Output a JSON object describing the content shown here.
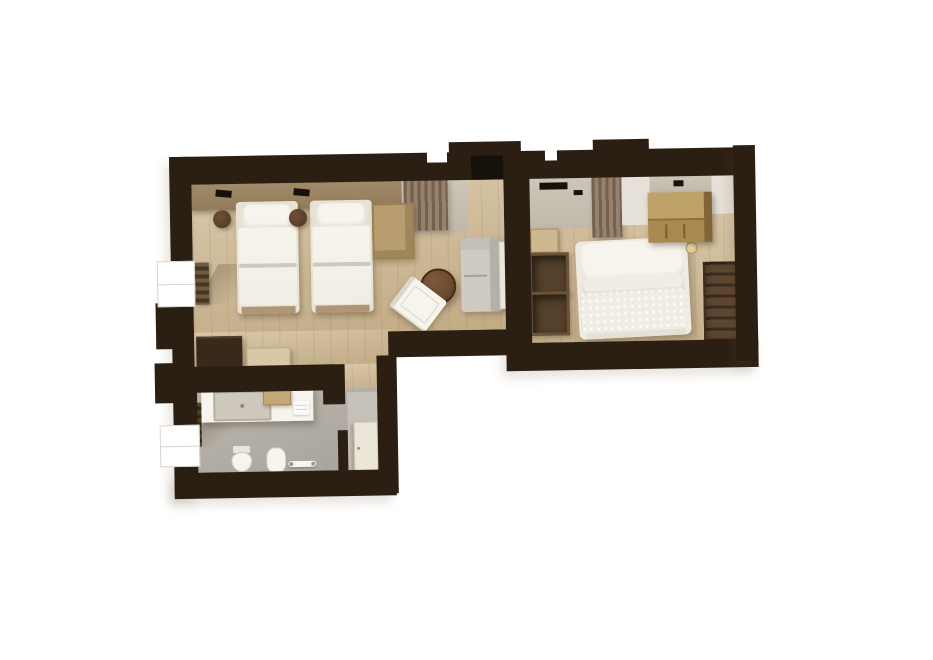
{
  "palette": {
    "white": "#ffffff",
    "wall": "#2b1e13",
    "wood1": "#d9c9ab",
    "wood2": "#cdb997",
    "wood3": "#c2ab85",
    "bath1": "#bcb7ae",
    "bath2": "#a8a39a",
    "niche": "#c6c1b8",
    "linen": "#f0ede5",
    "linenHi": "#f7f4ed",
    "grey": "#c0b8aa",
    "panel": "#e5e1d9",
    "curtainA": "#75604e",
    "curtainB": "#95816d",
    "sofa": "#cfcbc4",
    "sofaBack": "#b5b1aa",
    "walnut": "#6a4930",
    "oak": "#b89e6f",
    "oakEdge": "#9a7f57",
    "chest": "#b79a5d",
    "chestFront": "#a8894f",
    "dark": "#38291a",
    "ward": "#55412b",
    "shelf": "#5e4731",
    "radiator": "#493621",
    "sill": "#dbd6cd",
    "headboard": "#937c5b",
    "cream": "#ece6d9"
  },
  "scene": {
    "kind": "3d-floor-plan-render",
    "background": "#ffffff",
    "rooms": [
      {
        "id": "twin-bedroom",
        "label": "Twin bedroom",
        "floor": "wood",
        "furniture": [
          {
            "id": "twin-bed-1",
            "label": "Twin bed"
          },
          {
            "id": "twin-bed-2",
            "label": "Twin bed"
          },
          {
            "id": "nightstand-1",
            "label": "Nightstand"
          },
          {
            "id": "nightstand-2",
            "label": "Nightstand"
          },
          {
            "id": "desk",
            "label": "Desk"
          },
          {
            "id": "side-table",
            "label": "Round side table"
          },
          {
            "id": "lounge-chair",
            "label": "Lounge chair"
          },
          {
            "id": "luggage-cabinet",
            "label": "Cabinet"
          },
          {
            "id": "bench",
            "label": "Bench"
          },
          {
            "id": "radiator",
            "label": "Radiator"
          },
          {
            "id": "window",
            "label": "Window"
          }
        ]
      },
      {
        "id": "entrance-hall",
        "label": "Entrance hall",
        "floor": "wood",
        "furniture": [
          {
            "id": "entry-door",
            "label": "Entrance door"
          },
          {
            "id": "curtain",
            "label": "Curtain"
          },
          {
            "id": "sofa",
            "label": "Sofa"
          },
          {
            "id": "door-leaf",
            "label": "Open door"
          }
        ]
      },
      {
        "id": "double-bedroom",
        "label": "Double bedroom",
        "floor": "wood",
        "furniture": [
          {
            "id": "double-bed",
            "label": "Double bed"
          },
          {
            "id": "dresser",
            "label": "Dresser"
          },
          {
            "id": "wardrobe",
            "label": "Open wardrobe"
          },
          {
            "id": "wall-shelving",
            "label": "Wall shelving"
          },
          {
            "id": "curtains",
            "label": "Curtains"
          },
          {
            "id": "wall-tv",
            "label": "Wall TV"
          },
          {
            "id": "bedside-lamp",
            "label": "Bedside lamp"
          },
          {
            "id": "step-shelf",
            "label": "Wood shelf"
          }
        ]
      },
      {
        "id": "bathroom",
        "label": "Bathroom",
        "floor": "tile",
        "furniture": [
          {
            "id": "vanity",
            "label": "Vanity with washbasin"
          },
          {
            "id": "toilet",
            "label": "Toilet"
          },
          {
            "id": "bidet",
            "label": "Bidet"
          },
          {
            "id": "towel-radiator",
            "label": "Towel radiator"
          },
          {
            "id": "towel-bar",
            "label": "Towel bar"
          },
          {
            "id": "bathroom-door",
            "label": "Bathroom door"
          },
          {
            "id": "window",
            "label": "Window"
          },
          {
            "id": "towel-shelf",
            "label": "Towel shelf"
          },
          {
            "id": "towel",
            "label": "Towel"
          }
        ]
      }
    ]
  }
}
